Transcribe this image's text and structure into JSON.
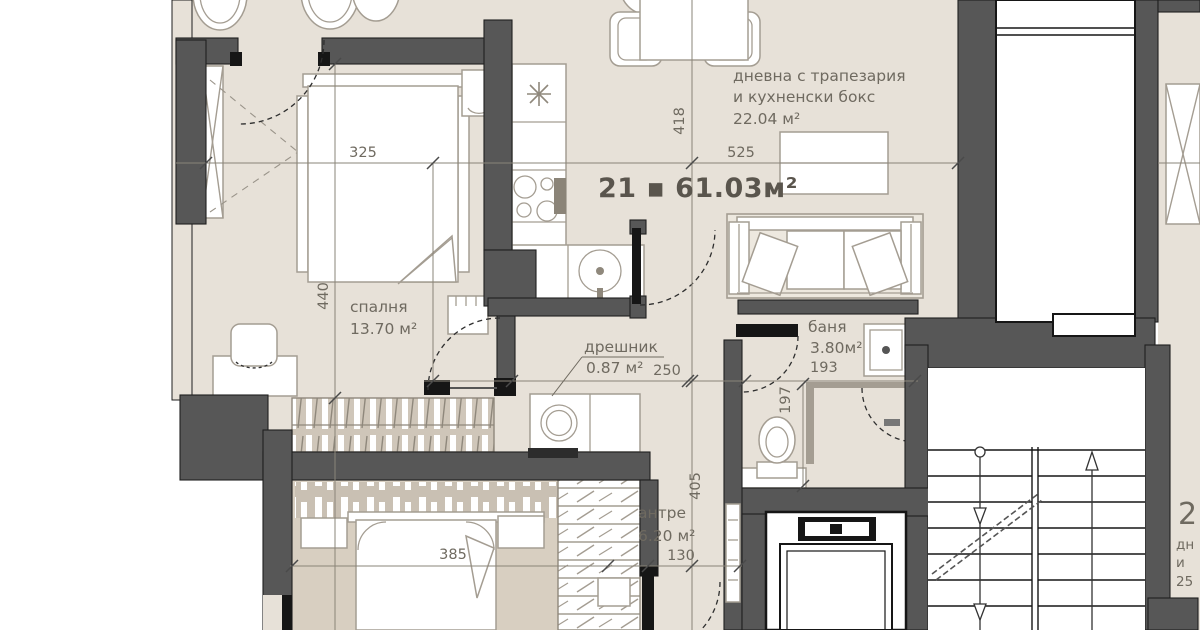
{
  "plan": {
    "title": "21 ▪ 61.03м²",
    "rooms": {
      "living": {
        "line1": "дневна с трапезария",
        "line2": "и кухненски бокс",
        "area": "22.04 м²"
      },
      "bedroom": {
        "name": "спалня",
        "area": "13.70 м²"
      },
      "closet": {
        "name": "дрешник",
        "area": "0.87 м²"
      },
      "bath": {
        "name": "баня",
        "area": "3.80м²"
      },
      "hall": {
        "name": "антре",
        "area": "6.20 м²"
      }
    },
    "dimensions": {
      "bedroom_width": "325",
      "bedroom_height": "440",
      "living_width": "525",
      "living_height": "418",
      "closet_width": "250",
      "bath_width": "193",
      "wc_height": "197",
      "hall_height": "405",
      "hall_door": "130",
      "bedroom2_width": "385"
    },
    "neighbor": {
      "number": "2",
      "line1": "дн",
      "line2": "и",
      "line3": "25"
    },
    "colors": {
      "floor": "#E7E1D8",
      "floor2": "#D8CFC1",
      "wall": "#575757",
      "text": "#6F6A60"
    }
  }
}
